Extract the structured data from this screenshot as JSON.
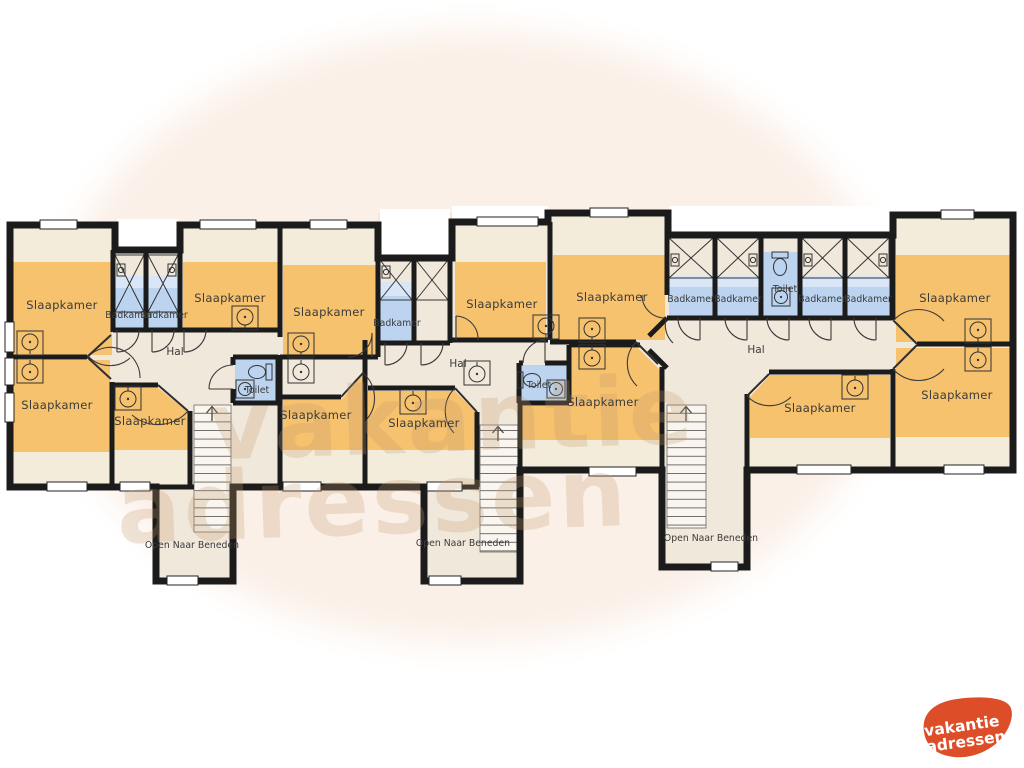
{
  "plan": {
    "bedrooms": [
      {
        "id": "bedroom-1",
        "label": "Slaapkamer"
      },
      {
        "id": "bedroom-2",
        "label": "Slaapkamer"
      },
      {
        "id": "bedroom-3",
        "label": "Slaapkamer"
      },
      {
        "id": "bedroom-4",
        "label": "Slaapkamer"
      },
      {
        "id": "bedroom-5",
        "label": "Slaapkamer"
      },
      {
        "id": "bedroom-6",
        "label": "Slaapkamer"
      },
      {
        "id": "bedroom-7",
        "label": "Slaapkamer"
      },
      {
        "id": "bedroom-8",
        "label": "Slaapkamer"
      },
      {
        "id": "bedroom-9",
        "label": "Slaapkamer"
      },
      {
        "id": "bedroom-10",
        "label": "Slaapkamer"
      },
      {
        "id": "bedroom-11",
        "label": "Slaapkamer"
      },
      {
        "id": "bedroom-12",
        "label": "Slaapkamer"
      },
      {
        "id": "bedroom-13",
        "label": "Slaapkamer"
      }
    ],
    "bathrooms": [
      {
        "id": "bathroom-1",
        "label": "Badkamer"
      },
      {
        "id": "bathroom-2",
        "label": "Badkamer"
      },
      {
        "id": "bathroom-3",
        "label": "Badkamer"
      },
      {
        "id": "bathroom-4",
        "label": "Badkamer"
      },
      {
        "id": "bathroom-5",
        "label": "Badkamer"
      },
      {
        "id": "bathroom-6",
        "label": "Badkamer"
      },
      {
        "id": "bathroom-7",
        "label": "Badkamer"
      }
    ],
    "toilets": [
      {
        "id": "toilet-1",
        "label": "Toilet"
      },
      {
        "id": "toilet-2",
        "label": "Toilet"
      },
      {
        "id": "toilet-3",
        "label": "Toilet"
      }
    ],
    "halls": [
      {
        "id": "hall-1",
        "label": "Hal"
      },
      {
        "id": "hall-2",
        "label": "Hal"
      },
      {
        "id": "hall-3",
        "label": "Hal"
      }
    ],
    "stair_voids": [
      {
        "id": "void-1",
        "label": "Open Naar Beneden"
      },
      {
        "id": "void-2",
        "label": "Open Naar Beneden"
      },
      {
        "id": "void-3",
        "label": "Open Naar Beneden"
      }
    ]
  },
  "watermark": {
    "line1": "vakantie",
    "line2": "adressen"
  },
  "logo": {
    "line1": "vakantie",
    "line2": "adressen"
  },
  "colors": {
    "bedroom_fill": "#f6c26e",
    "ceiling_band": "#f3ecdb",
    "hall_floor": "#f1e8dc",
    "bathroom_fill": "#bcd4ef",
    "bathroom_light": "#d9e6f7",
    "wall": "#1b1b1b",
    "backdrop": "#fbf0e8",
    "watermark_tan": "#c49a6c",
    "logo_red": "#dd4d28"
  }
}
